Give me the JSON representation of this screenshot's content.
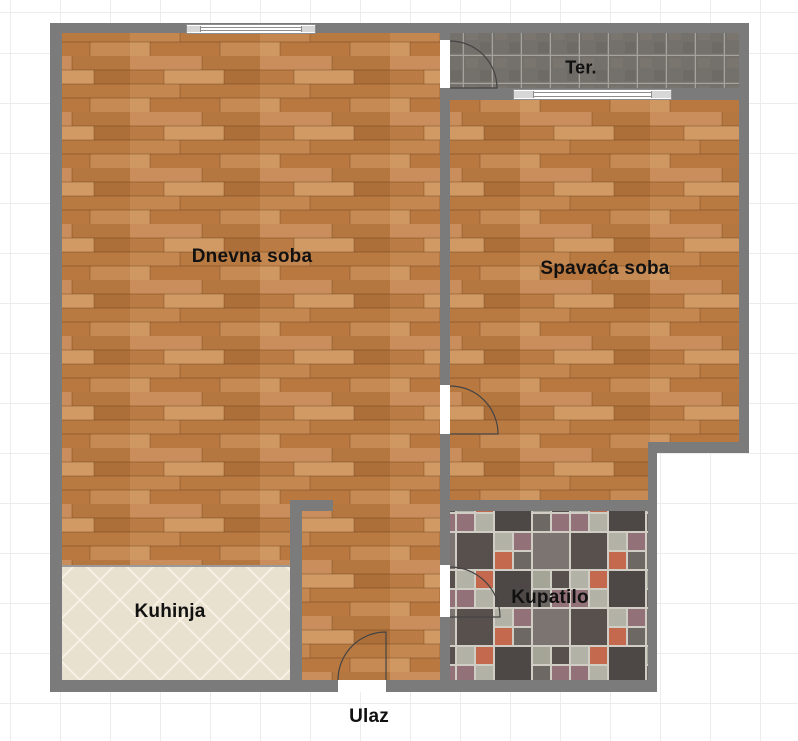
{
  "floorplan": {
    "rooms": [
      {
        "name": "living-room",
        "label": "Dnevna soba"
      },
      {
        "name": "bedroom",
        "label": "Spavaća soba"
      },
      {
        "name": "terrace",
        "label": "Ter."
      },
      {
        "name": "kitchen",
        "label": "Kuhinja"
      },
      {
        "name": "bathroom",
        "label": "Kupatilo"
      },
      {
        "name": "entrance",
        "label": "Ulaz"
      }
    ],
    "colors": {
      "wall": "#7b7b7b",
      "wood_floor_base": "#c0814e",
      "terrace_tile": "#74706b",
      "terrace_grout": "#a6a29c",
      "kitchen_tile": "#e9e1cf",
      "bathroom_grout": "#cfcdc4",
      "bathroom_dark_tile": "#57504d",
      "bathroom_sage_tile": "#b2b3a6",
      "bathroom_terracotta_tile": "#c4684e",
      "bathroom_mauve_tile": "#927179",
      "label_text": "#111111",
      "grid_line": "#ececec",
      "background": "#ffffff"
    }
  }
}
